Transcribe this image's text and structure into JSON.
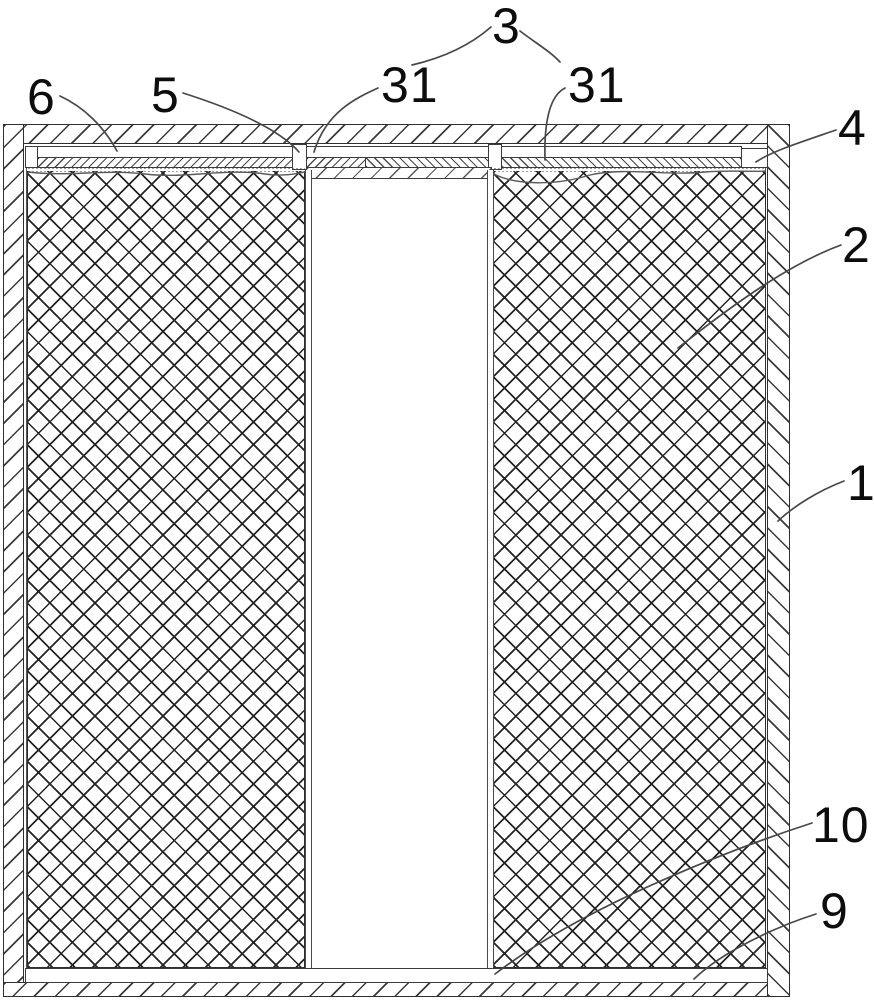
{
  "figure": {
    "type": "patent-cross-section-diagram",
    "colors": {
      "line": "#2f2f2f",
      "background": "#ffffff"
    },
    "labels": [
      {
        "id": "3",
        "text": "3"
      },
      {
        "id": "31-left",
        "text": "31"
      },
      {
        "id": "31-right",
        "text": "31"
      },
      {
        "id": "6",
        "text": "6"
      },
      {
        "id": "5",
        "text": "5"
      },
      {
        "id": "4",
        "text": "4"
      },
      {
        "id": "2",
        "text": "2"
      },
      {
        "id": "1",
        "text": "1"
      },
      {
        "id": "10",
        "text": "10"
      },
      {
        "id": "9",
        "text": "9"
      }
    ]
  }
}
